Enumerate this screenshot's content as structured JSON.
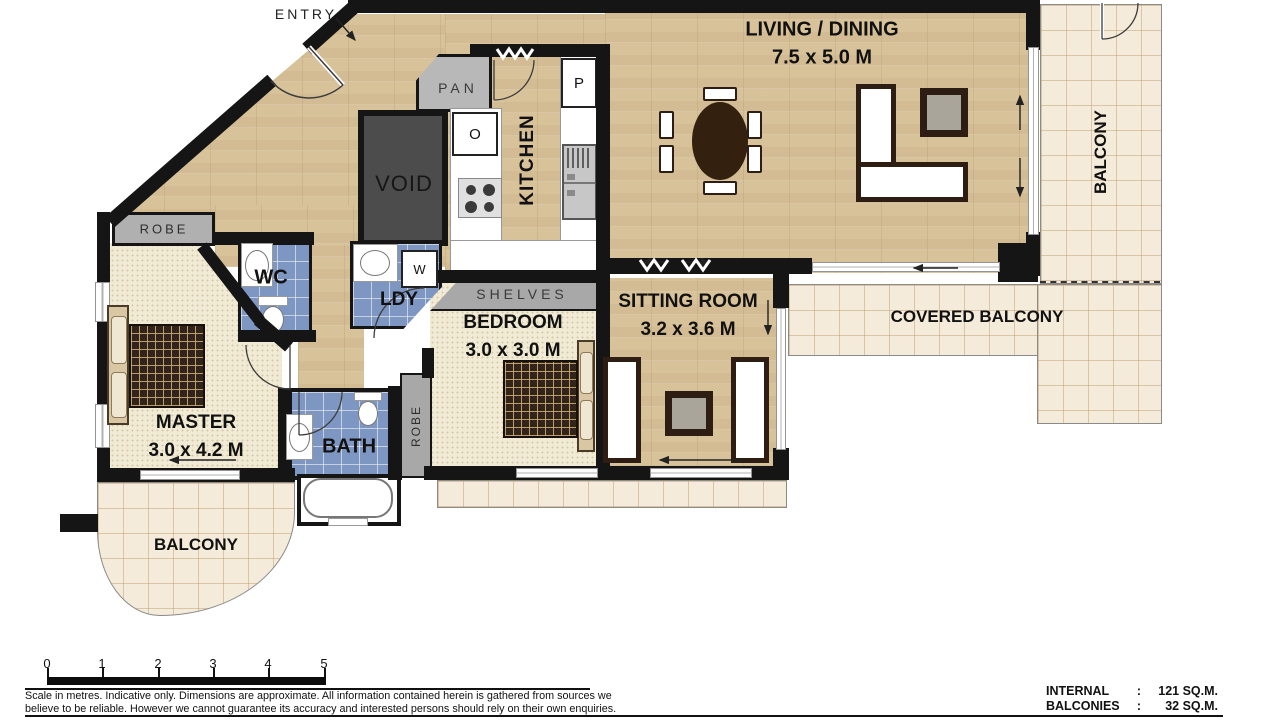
{
  "rooms": {
    "living": {
      "name": "LIVING / DINING",
      "dims": "7.5 x 5.0 M"
    },
    "sitting": {
      "name": "SITTING ROOM",
      "dims": "3.2 x 3.6 M"
    },
    "bedroom": {
      "name": "BEDROOM",
      "dims": "3.0 x 3.0 M"
    },
    "master": {
      "name": "MASTER",
      "dims": "3.0 x 4.2 M"
    },
    "kitchen": {
      "name": "KITCHEN"
    },
    "bath": {
      "name": "BATH"
    },
    "wc": {
      "name": "WC"
    },
    "laundry": {
      "name": "LDY"
    },
    "void": {
      "name": "VOID"
    },
    "pan": {
      "name": "PAN"
    },
    "entry": {
      "name": "ENTRY"
    },
    "shelves": {
      "name": "SHELVES"
    },
    "robe_master": {
      "name": "ROBE"
    },
    "robe_bedroom": {
      "name": "ROBE"
    },
    "balcony_right": {
      "name": "BALCONY"
    },
    "balcony_lower": {
      "name": "BALCONY"
    },
    "covered_balcony": {
      "name": "COVERED BALCONY"
    }
  },
  "appliances": {
    "oven": "O",
    "pantry": "P",
    "washer": "W"
  },
  "scale_bar": {
    "ticks": [
      "0",
      "1",
      "2",
      "3",
      "4",
      "5"
    ]
  },
  "disclaimer": {
    "line1": "Scale in metres.  Indicative only.  Dimensions are approximate.  All information contained herein is gathered from sources we",
    "line2": "believe to be reliable.  However we cannot guarantee its accuracy and interested persons should rely on their own enquiries."
  },
  "areas": {
    "internal_label": "INTERNAL",
    "internal_sep": ":",
    "internal_value": "121 SQ.M.",
    "balconies_label": "BALCONIES",
    "balconies_sep": ":",
    "balconies_value": "32 SQ.M."
  },
  "colors": {
    "wall": "#151515",
    "wood_floor": "#d8c29a",
    "carpet": "#f1ead4",
    "wet_area_tile": "#7e96c2",
    "balcony_tile": "#f4ebda",
    "fixture_gray": "#b0b0b0",
    "void_gray": "#4c4c4c",
    "furniture_brown": "#2e1d12"
  }
}
